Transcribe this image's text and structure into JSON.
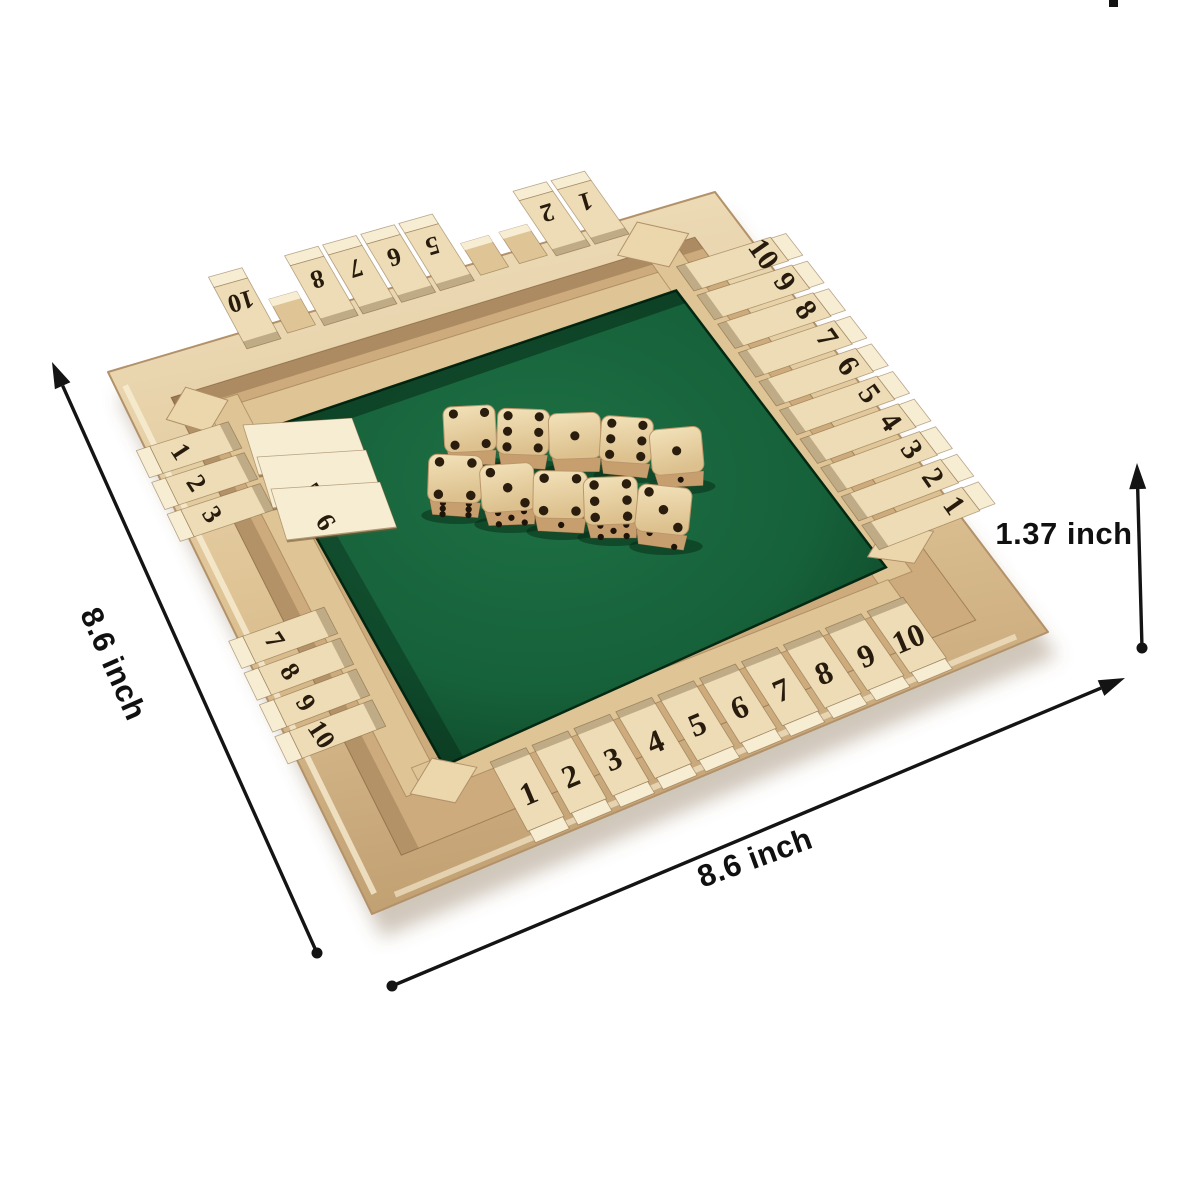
{
  "scene": {
    "description": "Wooden 4-way Shut The Box dice game board on white background with size annotations"
  },
  "annotations": {
    "left_dimension": "8.6 inch",
    "bottom_dimension": "8.6 inch",
    "height_dimension": "1.37 inch"
  },
  "board": {
    "rows": {
      "top": {
        "tiles": [
          {
            "n": "10",
            "state": "open"
          },
          {
            "n": "",
            "state": "tipped"
          },
          {
            "n": "8",
            "state": "open"
          },
          {
            "n": "7",
            "state": "open"
          },
          {
            "n": "6",
            "state": "open"
          },
          {
            "n": "5",
            "state": "open"
          },
          {
            "n": "",
            "state": "tipped"
          },
          {
            "n": "",
            "state": "tipped"
          },
          {
            "n": "2",
            "state": "open"
          },
          {
            "n": "1",
            "state": "open"
          }
        ]
      },
      "right": {
        "tiles": [
          {
            "n": "10",
            "state": "closed"
          },
          {
            "n": "9",
            "state": "closed"
          },
          {
            "n": "8",
            "state": "closed"
          },
          {
            "n": "7",
            "state": "closed"
          },
          {
            "n": "6",
            "state": "closed"
          },
          {
            "n": "5",
            "state": "closed"
          },
          {
            "n": "4",
            "state": "closed"
          },
          {
            "n": "3",
            "state": "closed"
          },
          {
            "n": "2",
            "state": "closed"
          },
          {
            "n": "1",
            "state": "closed"
          }
        ]
      },
      "left": {
        "tiles": [
          {
            "n": "1",
            "state": "closed"
          },
          {
            "n": "2",
            "state": "closed"
          },
          {
            "n": "3",
            "state": "closed"
          },
          {
            "n": "4",
            "state": "open"
          },
          {
            "n": "5",
            "state": "open"
          },
          {
            "n": "6",
            "state": "open"
          },
          {
            "n": "7",
            "state": "closed"
          },
          {
            "n": "8",
            "state": "closed"
          },
          {
            "n": "9",
            "state": "closed"
          },
          {
            "n": "10",
            "state": "closed"
          }
        ]
      },
      "bottom": {
        "tiles": [
          {
            "n": "1",
            "state": "closed"
          },
          {
            "n": "2",
            "state": "closed"
          },
          {
            "n": "3",
            "state": "closed"
          },
          {
            "n": "4",
            "state": "closed"
          },
          {
            "n": "5",
            "state": "closed"
          },
          {
            "n": "6",
            "state": "closed"
          },
          {
            "n": "7",
            "state": "closed"
          },
          {
            "n": "8",
            "state": "closed"
          },
          {
            "n": "9",
            "state": "closed"
          },
          {
            "n": "10",
            "state": "closed"
          }
        ]
      }
    }
  },
  "dice": {
    "back_row": [
      {
        "top": 4
      },
      {
        "top": 6
      },
      {
        "top": 1
      },
      {
        "top": 6
      },
      {
        "top": 1,
        "front": 1
      }
    ],
    "front_row": [
      {
        "top": 4,
        "front": 6
      },
      {
        "top": 3,
        "front": 5
      },
      {
        "top": 4,
        "front": 1
      },
      {
        "top": 6,
        "front": 5
      },
      {
        "top": 3,
        "front": 2
      }
    ]
  },
  "colors": {
    "background": "#ffffff",
    "felt": "#16613a",
    "felt_bright": "#1e7044",
    "felt_dark": "#0a3b20",
    "wood_light": "#f1e3c2",
    "wood_mid": "#dfc496",
    "wood_dark": "#c2a173",
    "wood_shadow": "#a9875a",
    "tile_face": "#eddcb5",
    "tile_cap": "#f7edd2",
    "tile_side": "#cfae7f",
    "number_ink": "#271b0d",
    "dice_top": "#ecd5a9",
    "dice_front": "#c79f6f",
    "pip": "#2b1d0e",
    "dimension_ink": "#141414"
  }
}
